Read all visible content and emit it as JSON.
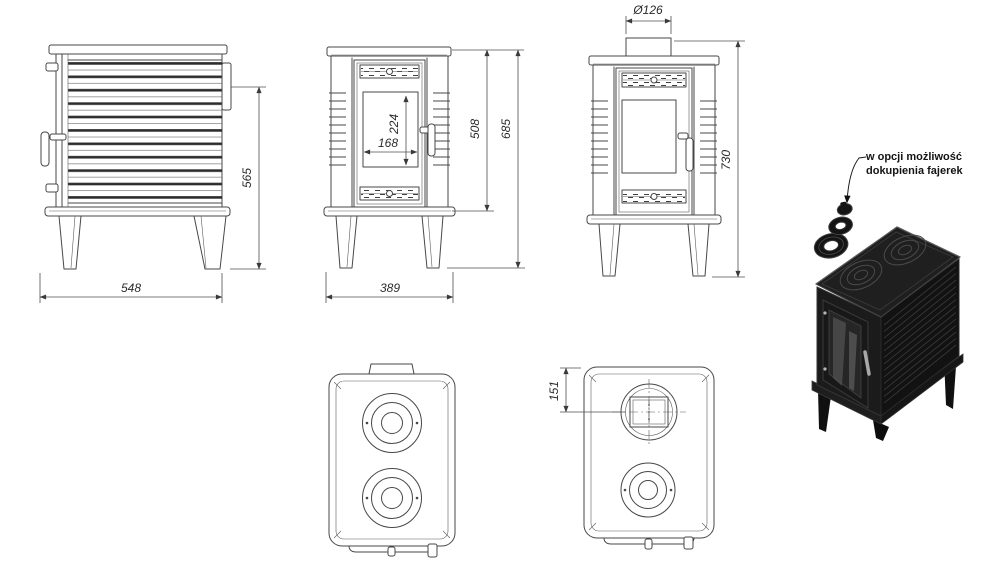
{
  "sheet": {
    "note": {
      "line1": "w opcji możliwość",
      "line2": "dokupienia fajerek"
    },
    "dimensions": {
      "side_width": "548",
      "side_height": "565",
      "glass_width": "168",
      "glass_height": "224",
      "front_width": "389",
      "body_height": "508",
      "total_height": "685",
      "flue_diameter": "Ø126",
      "overall_height_with_flue": "730",
      "flue_center_offset": "151"
    },
    "colors": {
      "line": "#474747",
      "dim_text": "#2a2a2a",
      "stove_black": "#151515",
      "background": "#ffffff"
    }
  }
}
